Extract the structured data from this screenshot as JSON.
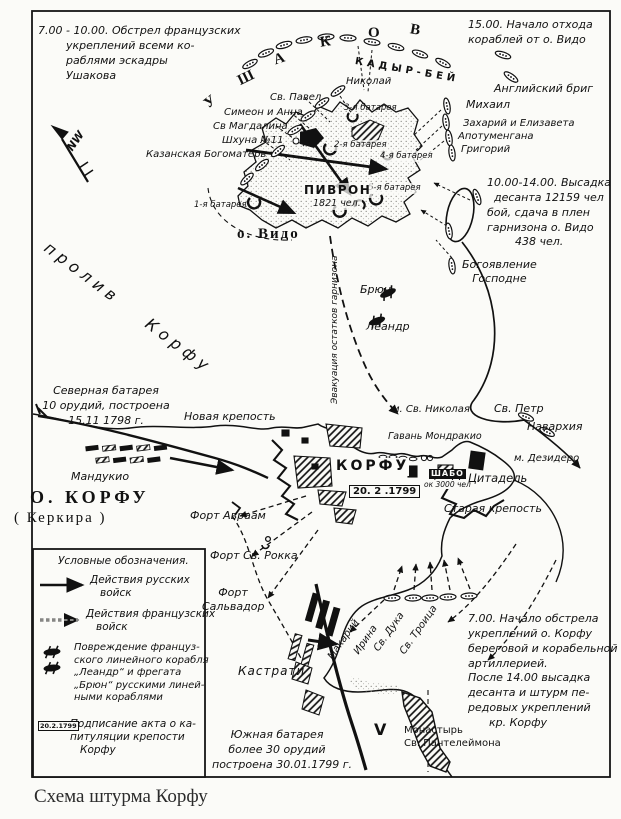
{
  "caption": "Схема штурма Корфу",
  "compass_label": "NW",
  "squadron": {
    "ushakov_letters": [
      "У",
      "Ш",
      "А",
      "К",
      "О",
      "В"
    ],
    "kadyr_bey": "КАДЫР-БЕЙ"
  },
  "notes": {
    "top_left": "7.00 - 10.00. Обстрел французских\n        укреплений всеми ко-\n        раблями эскадры\n        Ушакова",
    "top_right": "15.00. Начало отхода\nкораблей от о. Видо",
    "landing": "10.00-14.00. Высадка\n  десанта 12159 чел\nбой, сдача в плен\nгарнизона о. Видо\n        438 чел.",
    "bottom_right": "7.00. Начало обстрела\nукреплений о. Корфу\nбереговой и корабельной\nартиллерией.\nПосле 14.00 высадка\nдесанта и штурм пе-\nредовых укреплений\n      кр. Корфу"
  },
  "vido": {
    "name": "о. Видо",
    "strait": "пролив Корфу",
    "commander": "ПИВРОН",
    "strength": "1821 чел.",
    "batteries": [
      "1-я батарея",
      "2-я батарея",
      "3-я батарея",
      "4-я батарея",
      "5-я батарея"
    ],
    "evacuation": "Эвакуация остатков гарнизона"
  },
  "russian_ships": {
    "nikolay": "Николай",
    "pavel": "Св. Павел",
    "simeon": "Симеон и Анна",
    "magdalina": "Св Магдалина",
    "shkhuna": "Шхуна №11",
    "bogomater": "Казанская Богоматерь",
    "english_brig": "Английский бриг",
    "mikhail": "Михаил",
    "zakhariy": "Захарий и Елизавета",
    "apotumengana": "Апотуменгана",
    "grigoriy": "Григорий",
    "bogoyavlenie": "Богоявление\nГосподне",
    "st_petr": "Св. Петр",
    "navarkhia": "Навархия",
    "makariy": "Макарий",
    "irina": "Ирина",
    "duka": "Св. Дука",
    "troitsa": "Св. Троица"
  },
  "french_ships": {
    "bryun": "Брюн",
    "leandr": "Леандр"
  },
  "corfu": {
    "island": "О. КОРФУ",
    "island_alt": "( Керкира )",
    "city": "КОРФУ",
    "capitulation_date": "20. 2 .1799",
    "commander": "ШАБО",
    "strength": "ок 3000 чел",
    "new_fortress": "Новая крепость",
    "old_fortress": "Старая крепость",
    "citadel": "Цитадель",
    "harbor": "Гавань Мондракио",
    "cape_st_nikolay": "м. Св. Николая",
    "cape_desidero": "м. Дезидеро",
    "manduchio": "Мандукио",
    "fort_avraam": "Форт Авраам",
    "fort_rokka": "Форт Св. Рокка",
    "fort_salvador": "Форт\nСальвадор",
    "kastrati": "Кастрати",
    "monastery": "Монастырь\nСв. Пантелеймона",
    "monastery_mark": "V",
    "north_battery": "Северная батарея\n10 орудий, построена\n15.11 1798 г.",
    "south_battery": "Южная батарея\nболее 30 орудий\nпостроена 30.01.1799 г."
  },
  "legend": {
    "title": "Условные обозначения.",
    "russian": "Действия русских\n   войск",
    "french": "Действия французских\n   войск",
    "damage": "Повреждение француз-\nского линейного корабля\n„Леандр“ и фрегата\n„Брюн“ русскими линей-\nными кораблями",
    "capitulation": "Подписание акта о ка-\nпитуляции крепости\n   Корфу",
    "date_box": "20.2.1799"
  }
}
